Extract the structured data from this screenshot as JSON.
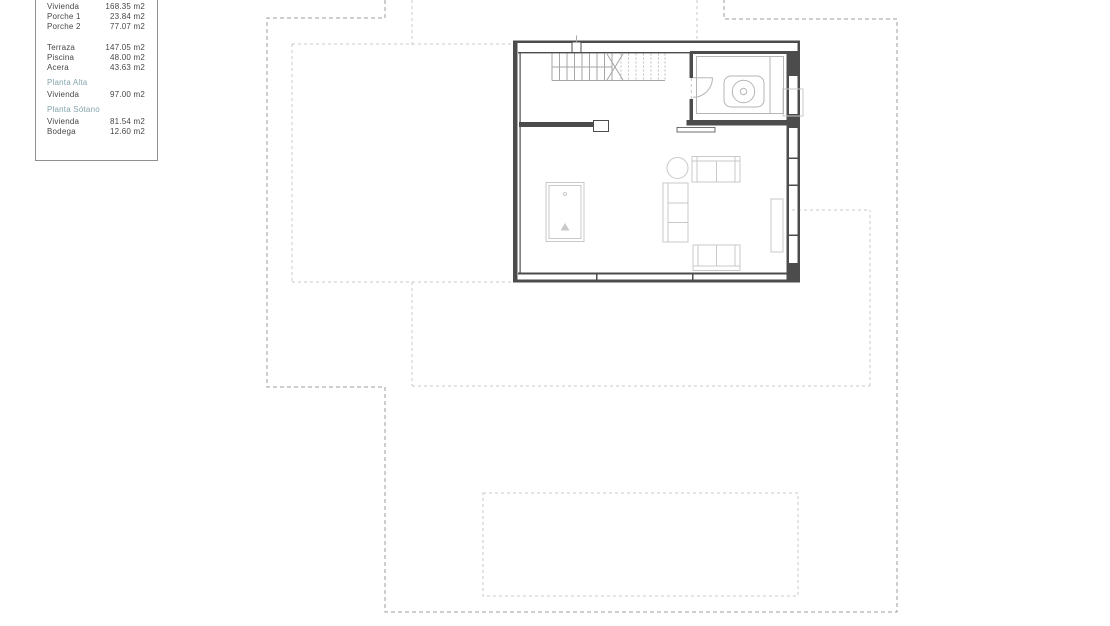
{
  "legend": {
    "rows": [
      {
        "type": "row",
        "label": "Vivienda",
        "value": "168.35 m2"
      },
      {
        "type": "row",
        "label": "Porche 1",
        "value": "23.84 m2"
      },
      {
        "type": "row",
        "label": "Porche 2",
        "value": "77.07 m2"
      },
      {
        "type": "gap"
      },
      {
        "type": "row",
        "label": "Terraza",
        "value": "147.05 m2"
      },
      {
        "type": "row",
        "label": "Piscina",
        "value": "48.00 m2"
      },
      {
        "type": "row",
        "label": "Acera",
        "value": "43.63 m2"
      },
      {
        "type": "header",
        "label": "Planta Alta"
      },
      {
        "type": "row",
        "label": "Vivienda",
        "value": "97.00 m2"
      },
      {
        "type": "header",
        "label": "Planta Sótano"
      },
      {
        "type": "row",
        "label": "Vivienda",
        "value": "81.54 m2"
      },
      {
        "type": "row",
        "label": "Bodega",
        "value": "12.60 m2"
      }
    ]
  },
  "colors": {
    "accent_teal": "#84a4ae",
    "text": "#474747",
    "wall": "#4c4c4c",
    "furniture": "#c9c9c9",
    "fixture": "#b5b5b5",
    "stairs": "#a6a6a6",
    "boundary_dark": "#9c9c9c",
    "boundary_light": "#c8c8c8",
    "bg": "#ffffff"
  }
}
